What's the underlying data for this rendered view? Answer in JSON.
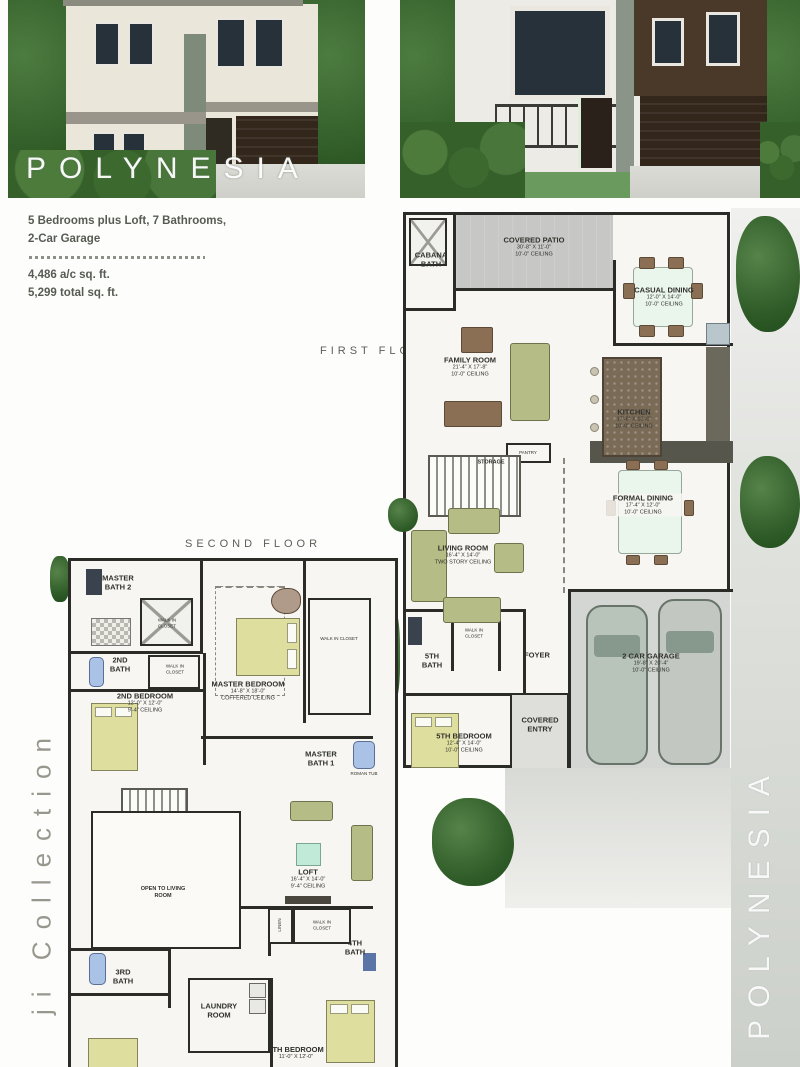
{
  "title_overlay": "POLYNESIA",
  "specs": {
    "bedrooms_line": "5 Bedrooms plus Loft, 7 Bathrooms,",
    "garage_line": "2-Car Garage",
    "ac_sqft": "4,486 a/c sq. ft.",
    "total_sqft": "5,299 total sq. ft."
  },
  "floor1": {
    "label": "FIRST FLOOR",
    "rooms": [
      {
        "name": "CABANA BATH"
      },
      {
        "name": "COVERED PATIO",
        "dims": "30'-8\" X 11'-0\"",
        "ceiling": "10'-0\" CEILING"
      },
      {
        "name": "CASUAL DINING",
        "dims": "12'-0\" X 14'-0\"",
        "ceiling": "10'-0\" CEILING"
      },
      {
        "name": "FAMILY ROOM",
        "dims": "21'-4\" X 17'-8\"",
        "ceiling": "10'-0\" CEILING"
      },
      {
        "name": "KITCHEN",
        "dims": "17'-8\" X 13'-0\"",
        "ceiling": "10'-0\" CEILING"
      },
      {
        "name": "STORAGE"
      },
      {
        "name": "PANTRY"
      },
      {
        "name": "FORMAL DINING",
        "dims": "17'-4\" X 12'-0\"",
        "ceiling": "10'-0\" CEILING"
      },
      {
        "name": "LIVING ROOM",
        "dims": "16'-4\" X 14'-0\"",
        "ceiling": "TWO STORY CEILING"
      },
      {
        "name": "WALK IN CLOSET"
      },
      {
        "name": "5TH BATH"
      },
      {
        "name": "FOYER"
      },
      {
        "name": "2 CAR GARAGE",
        "dims": "19'-8\" X 20'-4\"",
        "ceiling": "10'-0\" CEILING"
      },
      {
        "name": "COVERED ENTRY"
      },
      {
        "name": "5TH BEDROOM",
        "dims": "12'-4\" X 14'-0\"",
        "ceiling": "10'-0\" CEILING"
      }
    ]
  },
  "floor2": {
    "label": "SECOND FLOOR",
    "rooms": [
      {
        "name": "MASTER BATH 2"
      },
      {
        "name": "WALK IN CLOSET"
      },
      {
        "name": "2ND BATH"
      },
      {
        "name": "WALK IN CLOSET"
      },
      {
        "name": "2ND BEDROOM",
        "dims": "12'-0\" X 12'-0\"",
        "ceiling": "9'-4\" CEILING"
      },
      {
        "name": "MASTER BEDROOM",
        "dims": "14'-8\" X 18'-0\"",
        "ceiling": "COFFERED CEILING"
      },
      {
        "name": "WALK IN CLOSET"
      },
      {
        "name": "MASTER BATH 1"
      },
      {
        "name": "ROMAN TUB"
      },
      {
        "name": "OPEN TO LIVING ROOM"
      },
      {
        "name": "LOFT",
        "dims": "16'-4\" X 14'-0\"",
        "ceiling": "9'-4\" CEILING"
      },
      {
        "name": "WALK IN CLOSET"
      },
      {
        "name": "LINEN"
      },
      {
        "name": "4TH BATH"
      },
      {
        "name": "3RD BATH"
      },
      {
        "name": "LAUNDRY ROOM"
      },
      {
        "name": "4TH BEDROOM",
        "dims": "11'-0\" X 12'-0\""
      }
    ]
  },
  "side_left": "ji Collection",
  "side_right": "POLYNESIA",
  "colors": {
    "wall": "#2b2b28",
    "patio": "#c7c7c5",
    "garage": "#d3d6d2",
    "bed": "#dedf9f",
    "foliage": "#2f5c28"
  }
}
